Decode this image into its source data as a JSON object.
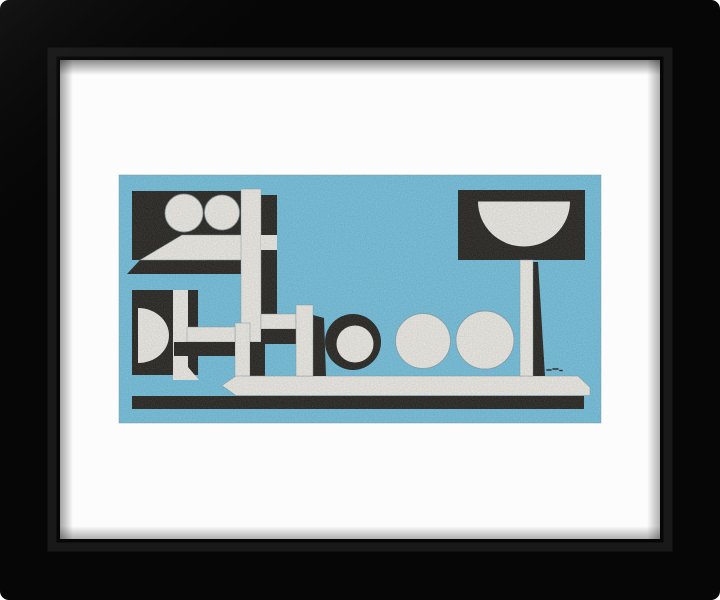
{
  "page": {
    "background": "#ffffff"
  },
  "frame": {
    "color": "#060606",
    "bevel": "#2a2a2a",
    "mat_color": "#fcfcfc"
  },
  "artwork": {
    "background": "#70c2e1",
    "ink_black": "#1c1b17",
    "paint_white": "#f2f0e9",
    "edge_gray": "#7e9aa4",
    "signature": "illegible artist signature"
  }
}
